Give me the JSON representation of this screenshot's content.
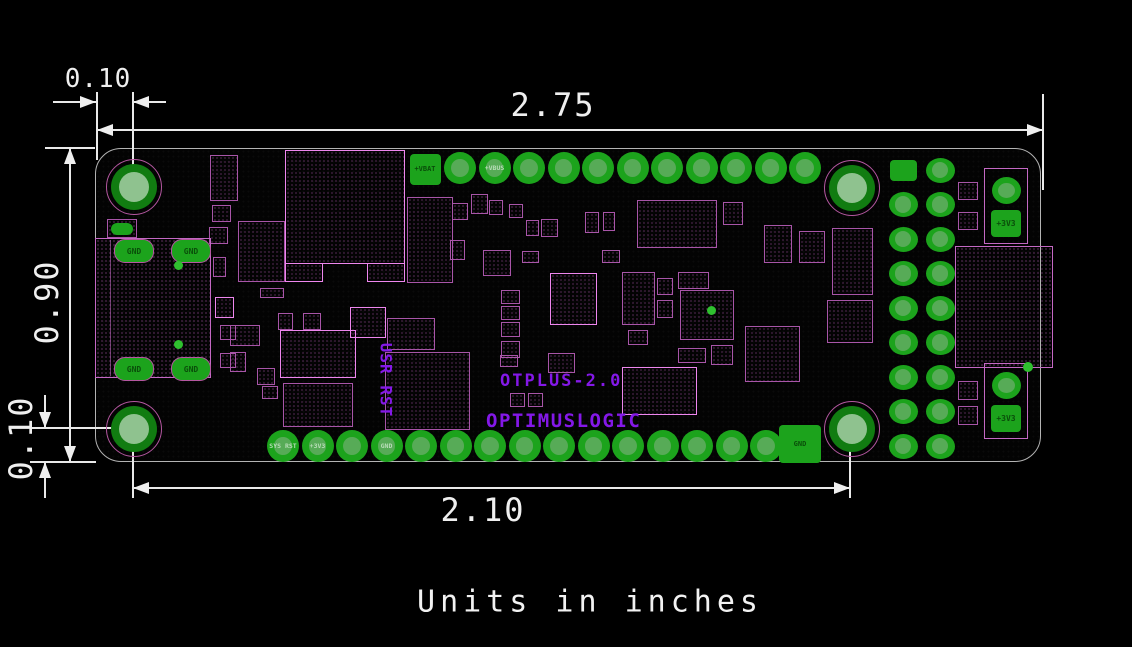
{
  "note": "Units in inches",
  "dimensions": {
    "board_width_in": "2.75",
    "hole_span_in": "2.10",
    "board_height_in": "0.90",
    "hole_offset_x_in": "0.10",
    "hole_offset_y_in": "0.10"
  },
  "board": {
    "name": "OTPLUS-2.0",
    "manufacturer": "OPTIMUSLOGIC",
    "button_labels": "USR RST",
    "colors": {
      "pad_green": "#1ca31c",
      "pad_center_green": "#57ab57",
      "pad_label_dark": "#0a4f0a",
      "pad_label_light": "#b7dcb7",
      "hole_ring_green": "#117c11",
      "hole_center_green": "#8fc28f",
      "hole_outline_magenta": "#b457a0",
      "component_pink": "#a855a8",
      "component_bright_pink": "#ee86ee",
      "silkscreen_purple": "#8418e8",
      "dimension_white": "#efefef"
    },
    "mounting_holes": [
      [
        133,
        186
      ],
      [
        851,
        187
      ],
      [
        133,
        428
      ],
      [
        851,
        428
      ]
    ],
    "top_pads": {
      "y": 168,
      "square": {
        "x": 425,
        "label": "+VBAT"
      },
      "start_x": 460,
      "pitch": 34.5,
      "count": 11,
      "labels": [
        "",
        "+VBUS",
        "",
        "",
        "",
        "",
        "",
        "",
        "",
        "",
        ""
      ]
    },
    "bottom_pads": {
      "y": 446,
      "start_x": 283,
      "pitch": 34.5,
      "count": 15,
      "labels": [
        "SYS RST",
        "+3V3",
        "",
        "GND",
        "",
        "",
        "",
        "",
        "",
        "",
        "",
        "",
        "",
        "",
        ""
      ],
      "end_square": {
        "x": 800,
        "label": "GND"
      }
    },
    "right_header": {
      "col_x": [
        903,
        940
      ],
      "row_start_y": 170,
      "pitch": 34.5,
      "rows": 9
    },
    "usb": {
      "x": 95,
      "y": 238,
      "w": 116,
      "h": 140,
      "pad_label": "GND",
      "pad_centers": [
        [
          133,
          250
        ],
        [
          190,
          250
        ],
        [
          133,
          368
        ],
        [
          190,
          368
        ]
      ]
    },
    "power_groups": [
      {
        "x": 984,
        "y": 168,
        "w": 44,
        "h": 76,
        "square_label": "+3V3"
      },
      {
        "x": 984,
        "y": 363,
        "w": 44,
        "h": 76,
        "square_label": "+3V3"
      }
    ],
    "right_connector": {
      "x": 955,
      "y": 246,
      "w": 98,
      "h": 122
    },
    "small_squares": [
      [
        958,
        182,
        20,
        18
      ],
      [
        958,
        212,
        20,
        18
      ],
      [
        958,
        381,
        20,
        19
      ],
      [
        958,
        406,
        20,
        19
      ]
    ],
    "dots": [
      [
        711,
        310,
        9
      ],
      [
        1028,
        367,
        10
      ],
      [
        178,
        265,
        9
      ],
      [
        178,
        344,
        9
      ]
    ],
    "components": [
      [
        210,
        155,
        28,
        46,
        0
      ],
      [
        285,
        150,
        120,
        114,
        1
      ],
      [
        285,
        263,
        38,
        19,
        1
      ],
      [
        367,
        263,
        38,
        19,
        1
      ],
      [
        238,
        221,
        47,
        61,
        0
      ],
      [
        212,
        205,
        19,
        17,
        0
      ],
      [
        209,
        227,
        19,
        17,
        0
      ],
      [
        407,
        197,
        46,
        86,
        0
      ],
      [
        452,
        203,
        16,
        17,
        0
      ],
      [
        450,
        240,
        15,
        20,
        0
      ],
      [
        471,
        194,
        17,
        20,
        0
      ],
      [
        489,
        200,
        14,
        15,
        0
      ],
      [
        509,
        204,
        14,
        14,
        0
      ],
      [
        526,
        220,
        13,
        16,
        0
      ],
      [
        541,
        219,
        17,
        18,
        0
      ],
      [
        585,
        212,
        14,
        21,
        0
      ],
      [
        603,
        212,
        12,
        19,
        0
      ],
      [
        637,
        200,
        80,
        48,
        0
      ],
      [
        723,
        202,
        20,
        23,
        0
      ],
      [
        764,
        225,
        28,
        38,
        0
      ],
      [
        799,
        231,
        26,
        32,
        0
      ],
      [
        832,
        228,
        41,
        67,
        0
      ],
      [
        827,
        300,
        46,
        43,
        0
      ],
      [
        483,
        250,
        28,
        26,
        0
      ],
      [
        522,
        251,
        17,
        12,
        0
      ],
      [
        602,
        250,
        18,
        13,
        0
      ],
      [
        550,
        273,
        47,
        52,
        1
      ],
      [
        622,
        272,
        33,
        53,
        0
      ],
      [
        657,
        278,
        16,
        17,
        0
      ],
      [
        657,
        300,
        16,
        18,
        0
      ],
      [
        678,
        272,
        31,
        17,
        0
      ],
      [
        680,
        290,
        54,
        50,
        0
      ],
      [
        501,
        290,
        19,
        14,
        0
      ],
      [
        501,
        306,
        19,
        14,
        0
      ],
      [
        501,
        322,
        19,
        15,
        0
      ],
      [
        501,
        341,
        19,
        17,
        0
      ],
      [
        548,
        353,
        27,
        20,
        0
      ],
      [
        628,
        330,
        20,
        15,
        0
      ],
      [
        678,
        348,
        28,
        15,
        0
      ],
      [
        711,
        345,
        22,
        20,
        0
      ],
      [
        745,
        326,
        55,
        56,
        0
      ],
      [
        260,
        288,
        24,
        10,
        0
      ],
      [
        278,
        313,
        15,
        17,
        0
      ],
      [
        303,
        313,
        18,
        17,
        0
      ],
      [
        230,
        325,
        30,
        21,
        0
      ],
      [
        230,
        352,
        16,
        20,
        0
      ],
      [
        257,
        368,
        18,
        17,
        0
      ],
      [
        262,
        386,
        16,
        13,
        0
      ],
      [
        280,
        330,
        76,
        48,
        1
      ],
      [
        283,
        383,
        70,
        44,
        0
      ],
      [
        350,
        307,
        36,
        31,
        1
      ],
      [
        387,
        318,
        48,
        32,
        0
      ],
      [
        385,
        352,
        85,
        78,
        0
      ],
      [
        622,
        367,
        75,
        48,
        1
      ],
      [
        510,
        393,
        15,
        14,
        0
      ],
      [
        528,
        393,
        15,
        14,
        0
      ],
      [
        500,
        355,
        18,
        12,
        0
      ],
      [
        213,
        257,
        13,
        20,
        0
      ],
      [
        215,
        297,
        19,
        21,
        1
      ],
      [
        220,
        325,
        16,
        15,
        0
      ],
      [
        220,
        353,
        16,
        15,
        0
      ],
      [
        107,
        219,
        30,
        19,
        0
      ]
    ]
  }
}
